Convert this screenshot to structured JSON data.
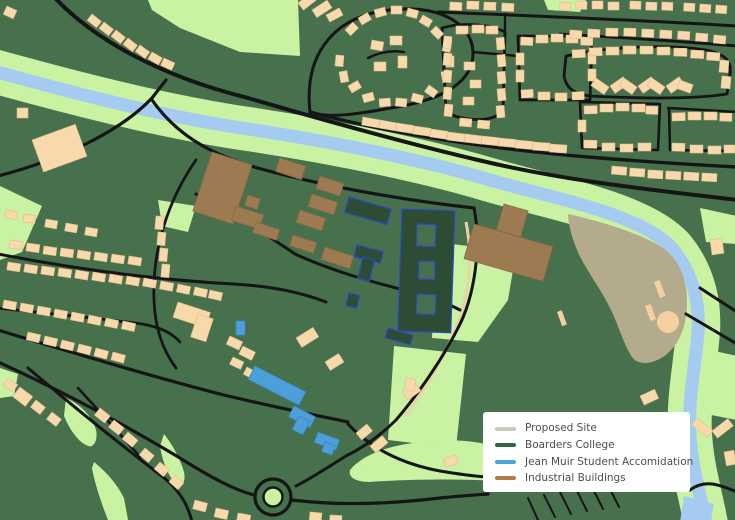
{
  "map": {
    "colors": {
      "background": "#47704d",
      "parkland": "#c9f2a2",
      "water": "#a5cbf0",
      "road": "#151515",
      "building": "#f8d9ab",
      "building_outline": "#e3bd8e",
      "industrial": "#9d7a52",
      "industrial_outline": "#8a6a45",
      "college_fill": "#2d4c33",
      "college_outline": "#2b49c9",
      "accommodation": "#4d9fd9",
      "accommodation_outline": "#3b86bf",
      "proposed_site": "#b4aa8c",
      "site_marking": "#f5cfa2",
      "footpath": "#ecd2a8"
    }
  },
  "legend": {
    "items": [
      {
        "label": "Proposed Site",
        "color": "#cbc7bd"
      },
      {
        "label": "Boarders College",
        "color": "#33663f"
      },
      {
        "label": "Jean Muir Student Accomidation",
        "color": "#4da3d8"
      },
      {
        "label": "Industrial Buildings",
        "color": "#b07c4c"
      }
    ]
  }
}
